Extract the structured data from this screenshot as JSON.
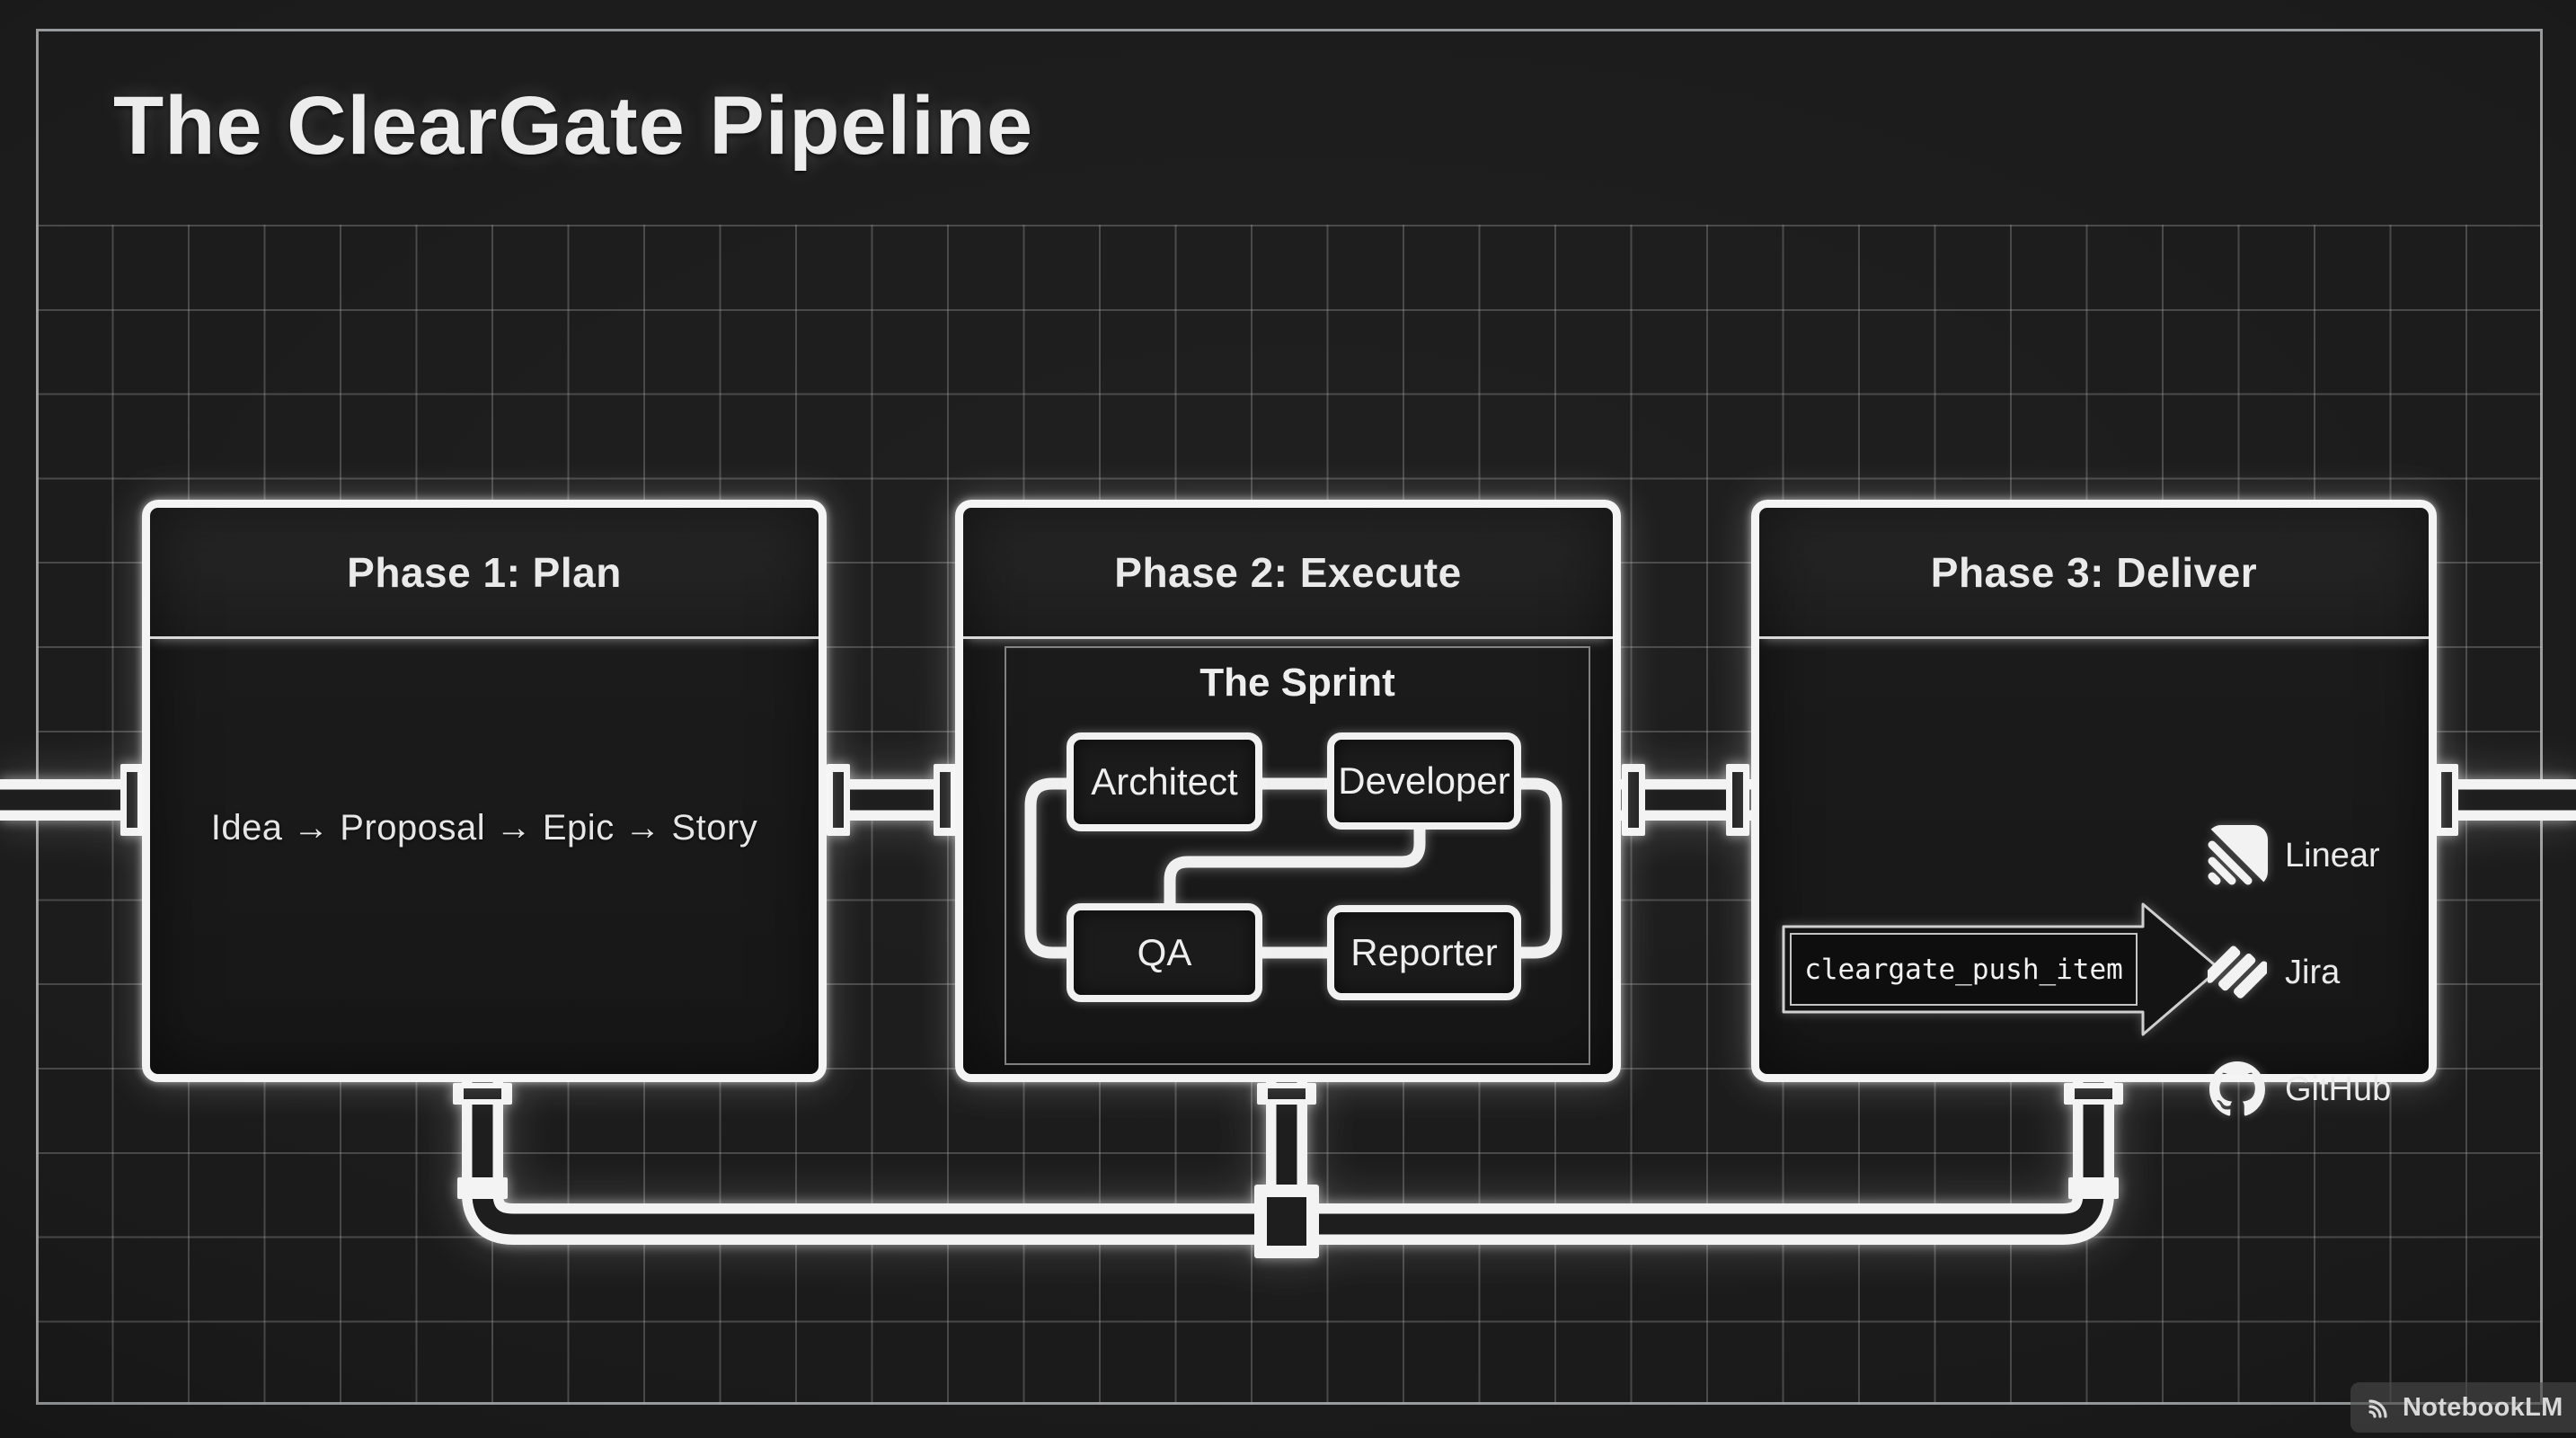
{
  "title": "The ClearGate Pipeline",
  "phases": [
    {
      "id": "plan",
      "title": "Phase 1: Plan",
      "flow": "Idea → Proposal → Epic → Story"
    },
    {
      "id": "execute",
      "title": "Phase 2: Execute",
      "sprint": {
        "label": "The Sprint",
        "roles": [
          "Architect",
          "Developer",
          "QA",
          "Reporter"
        ]
      }
    },
    {
      "id": "deliver",
      "title": "Phase 3: Deliver",
      "command": "cleargate_push_item",
      "targets": [
        {
          "name": "Linear",
          "icon": "linear-icon"
        },
        {
          "name": "Jira",
          "icon": "jira-icon"
        },
        {
          "name": "GitHub",
          "icon": "github-icon"
        }
      ]
    }
  ],
  "watermark": {
    "label": "NotebookLM",
    "icon": "notebooklm-icon"
  },
  "colors": {
    "background": "#1a1a1a",
    "grid_line": "#a8a8a8",
    "box_border": "#f4f4f4",
    "box_fill": "#1b1b1b",
    "pipe": "#f3f3f3",
    "text": "#eaeaea"
  }
}
